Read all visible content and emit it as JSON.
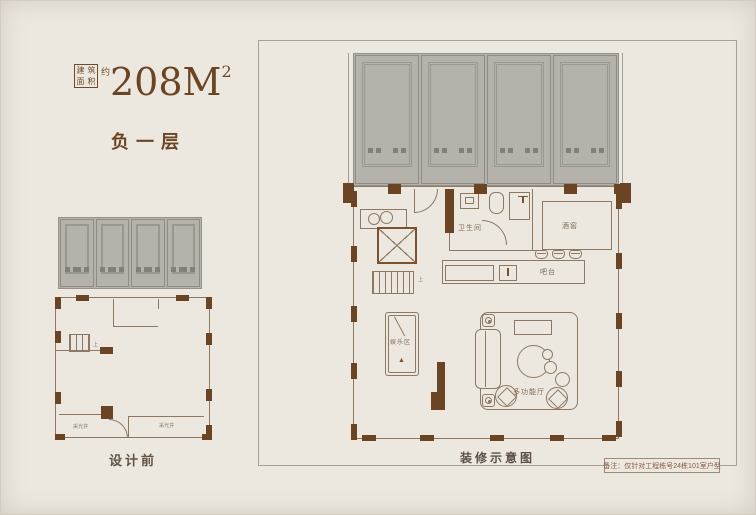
{
  "header": {
    "area_box_chars": [
      "建",
      "筑",
      "面",
      "积"
    ],
    "approx_char": "约",
    "area_value": "208M",
    "area_sup": "2",
    "floor_label": "负一层"
  },
  "small_plan": {
    "caption": "设计前",
    "labels": {
      "lightwell_left": "采光井",
      "lightwell_right": "采光井",
      "stairs_up": "上"
    }
  },
  "large_plan": {
    "caption": "装修示意图",
    "note": "备注：仅针对工程栋号24栋101室户型",
    "rooms": {
      "bathroom": "卫生间",
      "wine_cellar": "酒窖",
      "bar": "吧台",
      "entertainment": "娱乐区",
      "multi_hall": "多功能厅",
      "stairs_up": "上"
    },
    "icons": {
      "billiard_rack": "▲"
    }
  },
  "colors": {
    "background": "#ece8e0",
    "brand_brown": "#6b4424",
    "wall_pier_brown": "#6b4423",
    "plan_line": "#8d7863",
    "garage_gray": "#b5b2ac"
  }
}
